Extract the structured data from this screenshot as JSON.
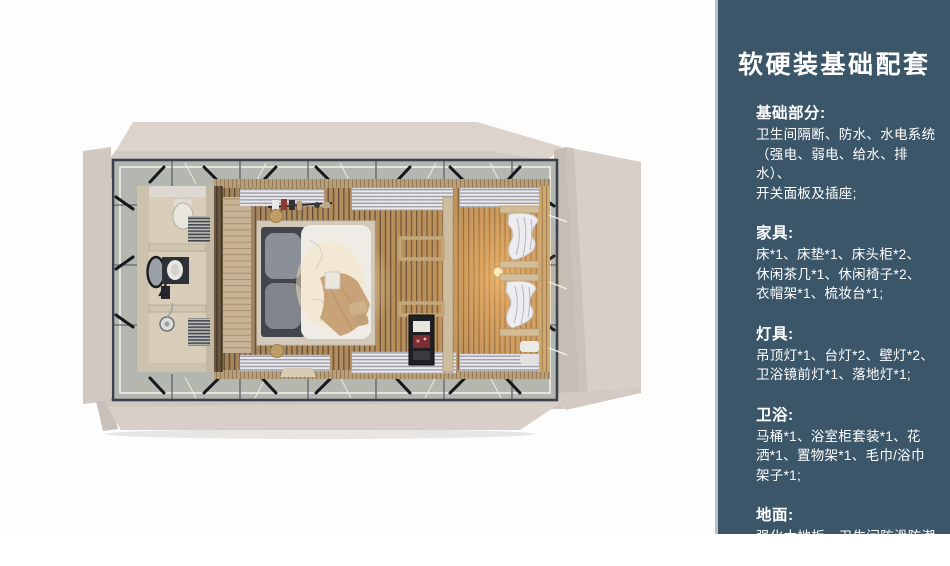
{
  "slide": {
    "panel_bg": "#3b5668",
    "text_color": "#ffffff",
    "title": "软硬装基础配套",
    "sections": [
      {
        "heading": "基础部分:",
        "body": "卫生间隔断、防水、水电系统\n（强电、弱电、给水、排水）、\n开关面板及插座;"
      },
      {
        "heading": "家具:",
        "body": "床*1、床垫*1、床头柜*2、\n休闲茶几*1、休闲椅子*2、\n衣帽架*1、梳妆台*1;"
      },
      {
        "heading": "灯具:",
        "body": "吊顶灯*1、台灯*2、壁灯*2、\n卫浴镜前灯*1、落地灯*1;"
      },
      {
        "heading": "卫浴:",
        "body": "马桶*1、浴室柜套装*1、花\n洒*1、置物架*1、毛巾/浴巾\n架子*1;"
      },
      {
        "heading": "地面:",
        "body": "强化木地板、卫生间防滑防潮\n石塑板;"
      }
    ]
  }
}
